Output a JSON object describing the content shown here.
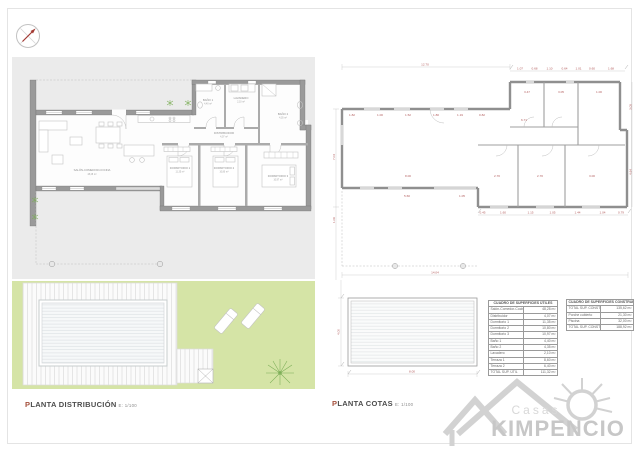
{
  "left_plan": {
    "title_first": "P",
    "title_rest": "LANTA DISTRIBUCIÓN",
    "scale": "E: 1/100",
    "rooms": [
      {
        "name": "SALÓN-COMEDOR-COCINA",
        "area": "48,28 m²"
      },
      {
        "name": "DISTRIBUIDOR",
        "area": "4,07 m²"
      },
      {
        "name": "DORMITORIO 1",
        "area": "11,35 m²"
      },
      {
        "name": "DORMITORIO 2",
        "area": "10,80 m²"
      },
      {
        "name": "DORMITORIO 3",
        "area": "10,97 m²"
      },
      {
        "name": "BAÑO 1",
        "area": "4,40 m²"
      },
      {
        "name": "LAVADERO",
        "area": "2,10 m²"
      },
      {
        "name": "BAÑO 2",
        "area": "4,35 m²"
      }
    ]
  },
  "right_plan": {
    "title_first": "P",
    "title_rest": "LANTA COTAS",
    "scale": "E: 1/100",
    "dims": {
      "top_long": "12.70",
      "top_row": [
        "1.07",
        "0.68",
        "1.10",
        "0.64",
        "1.01",
        "0.60",
        "1.68"
      ],
      "upper_rooms": [
        "3.47",
        "3.05",
        "1.00"
      ],
      "window_row": [
        "1.82",
        "1.00",
        "1.52",
        "1.80",
        "1.19",
        "0.82"
      ],
      "corridor": "6.71",
      "living_width": "8.00",
      "bedroom_widths": [
        "2.70",
        "2.70",
        "3.00"
      ],
      "porch_row": [
        "5.60",
        "1.05"
      ],
      "bottom_row": [
        "0.45",
        "1.60",
        "1.15",
        "1.05",
        "1.44",
        "1.04",
        "0.79"
      ],
      "right_vert": [
        "3.05",
        "4.64"
      ],
      "left_vert": "7.04",
      "left_vert2": "1.06",
      "total_width": "14.04"
    }
  },
  "pool_plan": {
    "width": "8.00",
    "height": "4.00"
  },
  "tables": {
    "utiles": {
      "title": "CUADRO DE SUPERFICIES ÚTILES",
      "rows": [
        {
          "label": "Salón-Comedor-Cocina",
          "value": "48,28 m²"
        },
        {
          "label": "Distribuidor",
          "value": "4,07 m²"
        },
        {
          "label": "Dormitorio 1",
          "value": "11,35 m²"
        },
        {
          "label": "Dormitorio 2",
          "value": "10,80 m²"
        },
        {
          "label": "Dormitorio 3",
          "value": "10,97 m²"
        },
        {
          "label": "Baño 1",
          "value": "4,40 m²"
        },
        {
          "label": "Baño 2",
          "value": "4,35 m²"
        },
        {
          "label": "Lavadero",
          "value": "2,10 m²"
        },
        {
          "label": "Terraza 1",
          "value": "8,60 m²"
        },
        {
          "label": "Terraza 2",
          "value": "6,40 m²"
        },
        {
          "label": "TOTAL SUP. ÚTIL",
          "value": "111,32 m²"
        }
      ]
    },
    "construidas": {
      "title": "CUADRO DE SUPERFICIES CONSTRUIDAS",
      "rows": [
        {
          "label": "TOTAL SUP. CONSTRUIDA VIVIENDA",
          "value": "135,62 m²"
        },
        {
          "label": "Porche cubierto",
          "value": "21,30 m²"
        },
        {
          "label": "Piscina",
          "value": "32,00 m²"
        },
        {
          "label": "TOTAL SUP. CONSTRUIDA",
          "value": "188,92 m²"
        }
      ]
    }
  },
  "logo": {
    "top": "Casas",
    "name": "KIMPENCIO"
  }
}
